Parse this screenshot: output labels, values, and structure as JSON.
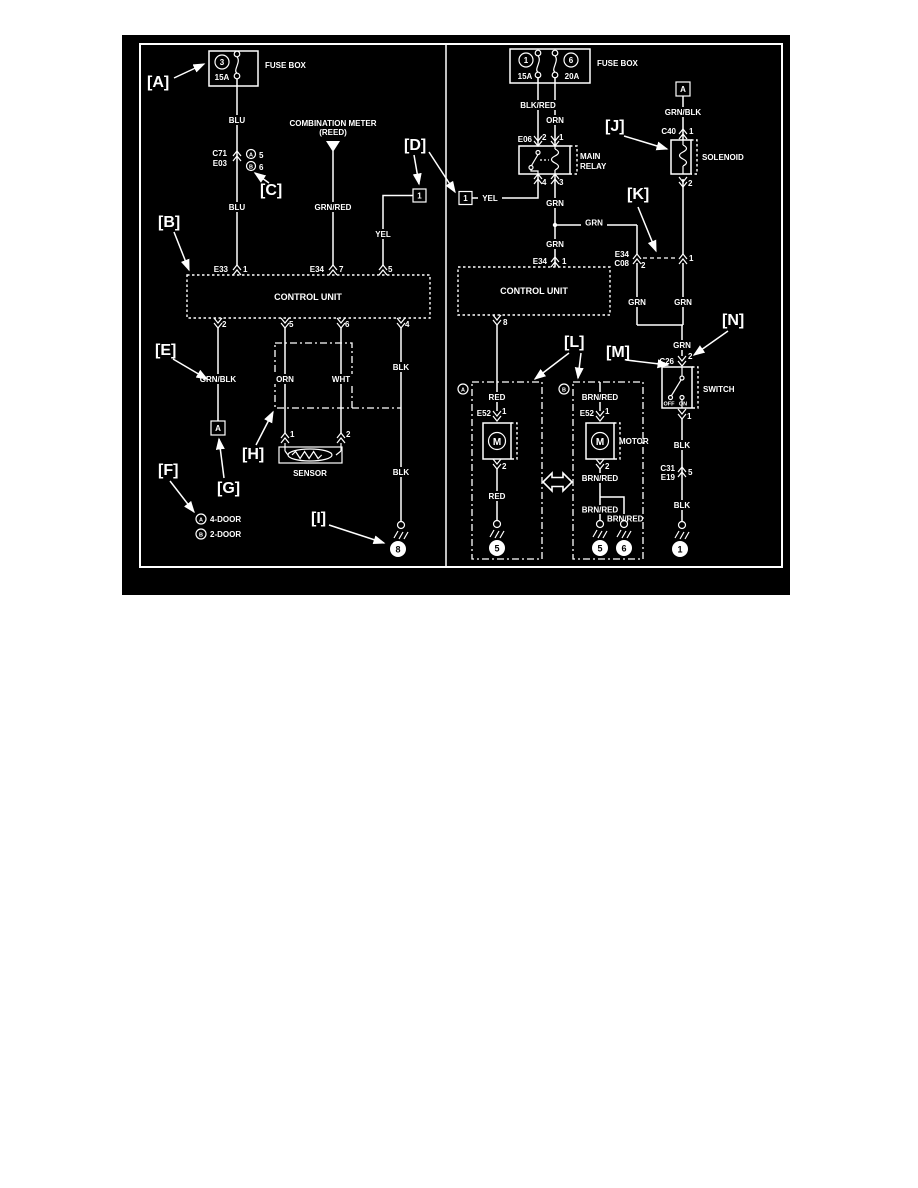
{
  "page": {
    "background": "#ffffff",
    "diagram_background": "#000000",
    "line_color": "#ffffff"
  },
  "tags": {
    "a": "[A]",
    "b": "[B]",
    "c": "[C]",
    "d": "[D]",
    "e": "[E]",
    "f": "[F]",
    "g": "[G]",
    "h": "[H]",
    "i": "[I]",
    "j": "[J]",
    "k": "[K]",
    "l": "[L]",
    "m": "[M]",
    "n": "[N]"
  },
  "left": {
    "fuse_num": "3",
    "fuse_amp": "15A",
    "fuse_box": "FUSE BOX",
    "blu1": "BLU",
    "blu2": "BLU",
    "c71": "C71",
    "e03": "E03",
    "opt_a": "A",
    "opt_a_pin": "5",
    "opt_b": "B",
    "opt_b_pin": "6",
    "meter1": "COMBINATION METER",
    "meter2": "(REED)",
    "grnred": "GRN/RED",
    "conn1": "1",
    "yel": "YEL",
    "e33": "E33",
    "e33p": "1",
    "e34": "E34",
    "e34p": "7",
    "p5": "5",
    "cu": "CONTROL UNIT",
    "b2": "2",
    "b5": "5",
    "b6": "6",
    "b4": "4",
    "grnblk": "GRN/BLK",
    "boxa": "A",
    "orn": "ORN",
    "wht": "WHT",
    "blk1": "BLK",
    "blk2": "BLK",
    "s1": "1",
    "s2": "2",
    "sensor": "SENSOR",
    "gnd": "8",
    "lega": "A",
    "legat": "4-DOOR",
    "legb": "B",
    "legbt": "2-DOOR"
  },
  "right": {
    "f1": "1",
    "f1a": "15A",
    "f6": "6",
    "f6a": "20A",
    "fuse_box": "FUSE BOX",
    "blkred": "BLK/RED",
    "orn": "ORN",
    "e06": "E06",
    "rp2": "2",
    "rp1": "1",
    "rp4": "4",
    "rp3": "3",
    "main": "MAIN",
    "relay": "RELAY",
    "conn1": "1",
    "yel": "YEL",
    "grn1": "GRN",
    "grn2": "GRN",
    "grn3": "GRN",
    "e34": "E34",
    "e34p": "1",
    "cu": "CONTROL UNIT",
    "cup": "8",
    "ce34": "E34",
    "cc08": "C08",
    "cp2": "2",
    "cp1": "1",
    "boxa": "A",
    "grnblk": "GRN/BLK",
    "c40": "C40",
    "c40p": "1",
    "solenoid": "SOLENOID",
    "solp2": "2",
    "grn4": "GRN",
    "grn5": "GRN",
    "grn6": "GRN",
    "c26": "C26",
    "c26p": "2",
    "off": "OFF",
    "on": "ON",
    "switch": "SWITCH",
    "swp1": "1",
    "blk1": "BLK",
    "c31": "C31",
    "e19": "E19",
    "c31p": "5",
    "blk2": "BLK",
    "gnd_sw": "1",
    "ma_opt": "A",
    "ma_red1": "RED",
    "ma_e52": "E52",
    "ma_p1": "1",
    "ma_m": "M",
    "ma_p2": "2",
    "ma_red2": "RED",
    "ma_gnd": "5",
    "mb_opt": "B",
    "mb_brn1": "BRN/RED",
    "mb_e52": "E52",
    "mb_p1": "1",
    "mb_m": "M",
    "mb_motor": "MOTOR",
    "mb_p2": "2",
    "mb_brn2": "BRN/RED",
    "mb_brn3": "BRN/RED",
    "mb_brn4": "BRN/RED",
    "mb_gnd5": "5",
    "mb_gnd6": "6"
  }
}
